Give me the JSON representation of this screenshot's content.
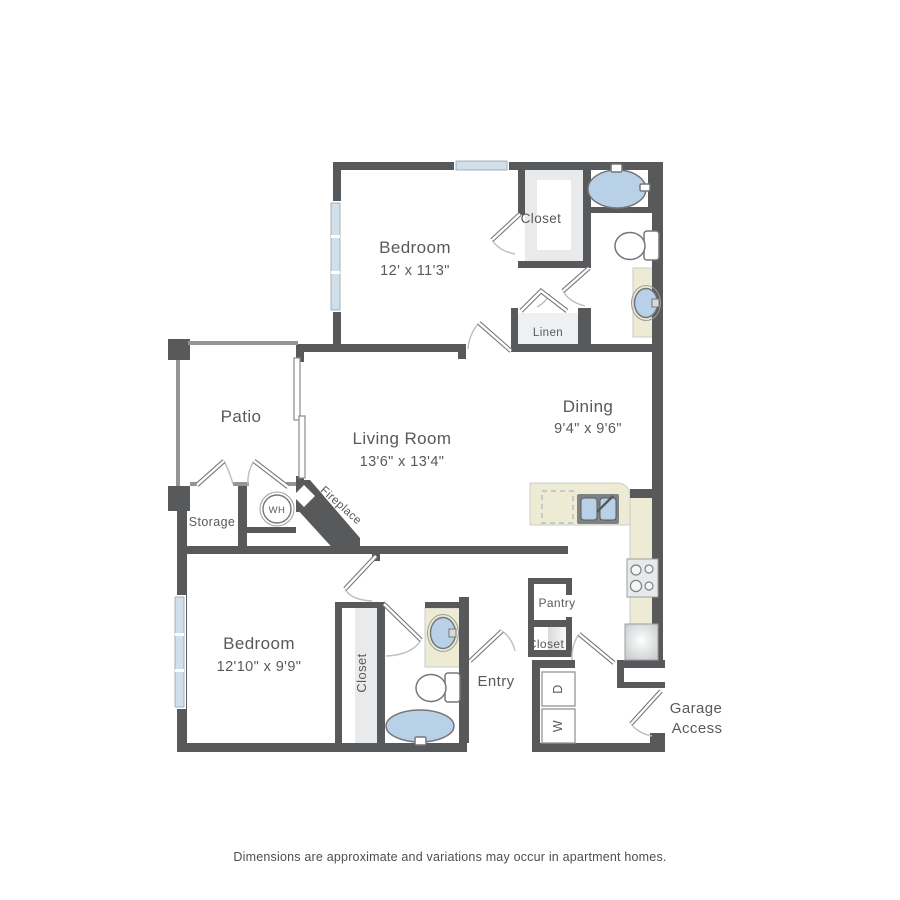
{
  "title": "Two bedroom apartment floor plan",
  "colors": {
    "wall": "#58595b",
    "thin_wall": "#939598",
    "window_glass": "#cfe0ec",
    "fixture_water": "#b9d1e7",
    "counter": "#edebd3",
    "text": "#58595b"
  },
  "rooms": {
    "bedroom1": {
      "name": "Bedroom",
      "dims": "12' x 11'3\""
    },
    "closet1": {
      "name": "Closet"
    },
    "linen": {
      "name": "Linen"
    },
    "patio": {
      "name": "Patio"
    },
    "living": {
      "name": "Living Room",
      "dims": "13'6\" x 13'4\""
    },
    "dining": {
      "name": "Dining",
      "dims": "9'4\" x 9'6\""
    },
    "storage": {
      "name": "Storage"
    },
    "water_heater": {
      "abbr": "WH"
    },
    "fireplace": {
      "line1": "Fireplace",
      "line2": "Option"
    },
    "bedroom2": {
      "name": "Bedroom",
      "dims": "12'10\" x 9'9\""
    },
    "closet2": {
      "name": "Closet"
    },
    "entry": {
      "name": "Entry"
    },
    "pantry": {
      "name": "Pantry"
    },
    "entry_closet": {
      "name": "Closet"
    },
    "laundry": {
      "dryer": "D",
      "washer": "W"
    },
    "garage": {
      "line1": "Garage",
      "line2": "Access"
    }
  },
  "footer": "Dimensions are approximate and variations may occur in apartment homes."
}
